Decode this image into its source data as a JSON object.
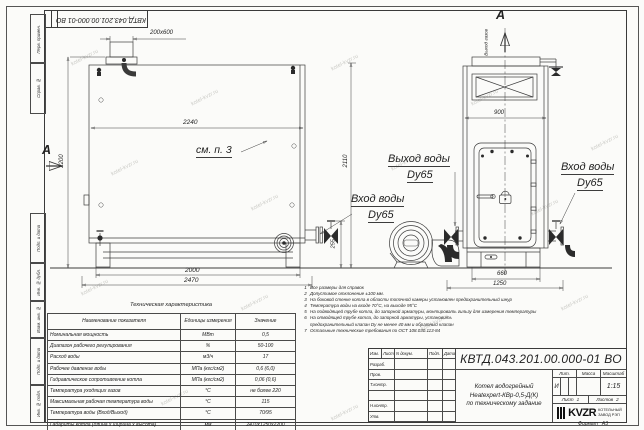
{
  "document": {
    "doc_number": "КВТД.043.201.00.000-01 ВО",
    "format_label": "Формат",
    "format_value": "А3"
  },
  "margin_stamps": {
    "top_stamp": "КВТД.043.201.00.000-01 ВО",
    "side_cells": [
      "Перв. примен.",
      "Справ. №",
      "Подп. и дата",
      "Инв. № дубл.",
      "Взам. инв. №",
      "Подп. и дата",
      "Инв. № подл."
    ]
  },
  "drawing": {
    "section_letter_left": "А",
    "section_letter_top": "А",
    "gas_outlet": "Выход газов",
    "see_note": "см. п. 3",
    "labels": {
      "water_outlet_1": "Выход воды",
      "water_outlet_2": "Dy65",
      "water_inlet_left_1": "Вход воды",
      "water_inlet_left_2": "Dy65",
      "water_inlet_right_1": "Вход воды",
      "water_inlet_right_2": "Dy65"
    },
    "dimensions": {
      "chimney": "200x600",
      "inner_width": "2240",
      "height_total": "2200",
      "height_front": "2110",
      "base_span": "2000",
      "length_total": "2470",
      "flange_height": "255",
      "front_top_width": "900",
      "front_base_width": "660",
      "front_total_width": "1250"
    }
  },
  "tech_table": {
    "title": "Техническая характеристика",
    "headers": {
      "name": "Наименование показателя",
      "unit": "Единицы измерения",
      "value": "Значение"
    },
    "rows": [
      {
        "name": "Номинальная мощность",
        "unit": "МВт",
        "value": "0,5"
      },
      {
        "name": "Диапазон рабочего регулирования",
        "unit": "%",
        "value": "50-100"
      },
      {
        "name": "Расход воды",
        "unit": "м3/ч",
        "value": "17"
      },
      {
        "name": "Рабочее давление воды",
        "unit": "МПа (кгс/см2)",
        "value": "0,6 (6,0)"
      },
      {
        "name": "Гидравлическое сопротивление котла",
        "unit": "МПа (кгс/см2)",
        "value": "0,06 (0,6)"
      },
      {
        "name": "Температура уходящих газов",
        "unit": "°С",
        "value": "не более 220"
      },
      {
        "name": "Максимальная рабочая температура воды",
        "unit": "°С",
        "value": "115"
      },
      {
        "name": "Температура воды (Вход/Выход)",
        "unit": "°С",
        "value": "70/95"
      },
      {
        "name": "Габариты котла (длина х ширина х высота)",
        "unit": "мм",
        "value": "2470х1250х2200"
      }
    ]
  },
  "notes": {
    "items": [
      {
        "num": "1",
        "text": "Все размеры для справок"
      },
      {
        "num": "2",
        "text": "Допустимое отклонение ±100 мм."
      },
      {
        "num": "3",
        "text": "На боковой стенке котла в области топочной камеры установлен предохранительный шнур"
      },
      {
        "num": "4",
        "text": "Температура воды на входе 70°С, на выходе 95°С"
      },
      {
        "num": "5",
        "text": "На подводящей трубе котла, до запорной арматуры, монтировать гильзу для измерения температуры"
      },
      {
        "num": "6",
        "text": "На отводящей трубе котла, до запорной арматуры, установить"
      },
      {
        "num": "",
        "text": "предохранительный клапан Dy не менее 40 мм и обратный клапан"
      },
      {
        "num": "7",
        "text": "Остальные технические требования по ОСТ 108.030.113-84"
      }
    ]
  },
  "title_block": {
    "doc_number": "КВТД.043.201.00.000-01 ВО",
    "product_line1": "Котел водогрейный",
    "product_line2": "Heatexpert-КВр-0,5-Д(К)",
    "product_line3": "по техническому задание",
    "rev_cols": [
      "Изм.",
      "Лист",
      "N докум.",
      "Подп.",
      "Дата"
    ],
    "sign_rows": [
      "Разраб.",
      "Пров.",
      "Т.контр.",
      " ",
      "Н.контр.",
      "Утв."
    ],
    "lit_label": "Лит.",
    "lit_value": "И",
    "mass_label": "Масса",
    "scale_label": "Масштаб",
    "scale_value": "1:15",
    "sheet_label": "Лист",
    "sheet_value": "1",
    "sheets_label": "Листов",
    "sheets_value": "2",
    "company": {
      "logo": "KVZR",
      "line1": "КОТЕЛЬНЫЙ",
      "line2": "ЗАВОД РЭП"
    }
  },
  "watermark": "kotel-kvzr.ru"
}
